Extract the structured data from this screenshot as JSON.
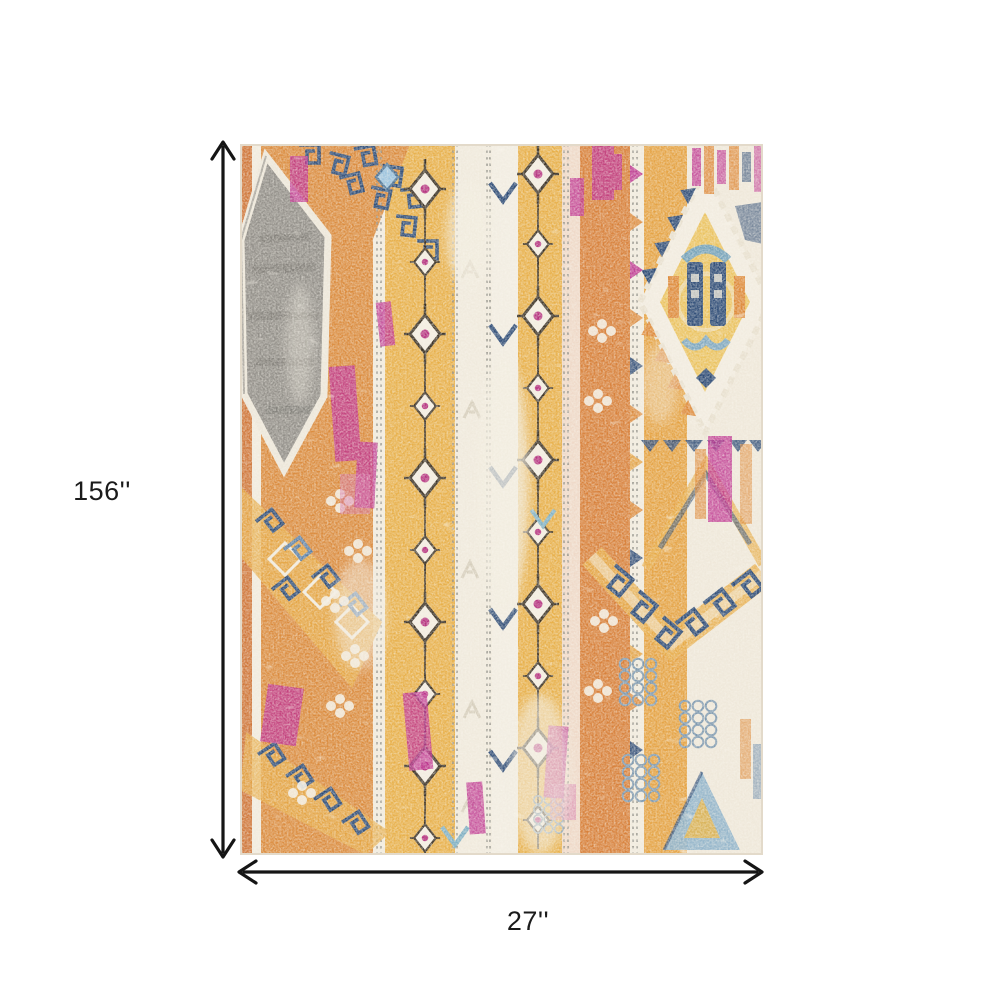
{
  "page": {
    "background_color": "#ffffff"
  },
  "annotation": {
    "height_label": "156''",
    "width_label": "27''",
    "arrow_color": "#151515",
    "label_color": "#1b1b1b"
  },
  "rug": {
    "description": "Colorful distressed bohemian tribal area rug with vertical striped pattern, gray hexagon medallion in upper left, cream and gold diamond medallion on right, navy Greek key motifs, diamond chains and chevrons in saffron, orange, magenta, navy, light blue, gray and cream",
    "palette": {
      "cream": "#F1EBDE",
      "gold": "#E8B04A",
      "saffron": "#E5A344",
      "orange": "#DB8C3F",
      "burnt_orange": "#D0783C",
      "magenta": "#BE3390",
      "navy": "#2E4C77",
      "steel_blue": "#5B7FA6",
      "light_blue": "#8FB3CA",
      "teal": "#74A2BA",
      "gray": "#928F89",
      "outline_dark": "#3B3226"
    }
  }
}
